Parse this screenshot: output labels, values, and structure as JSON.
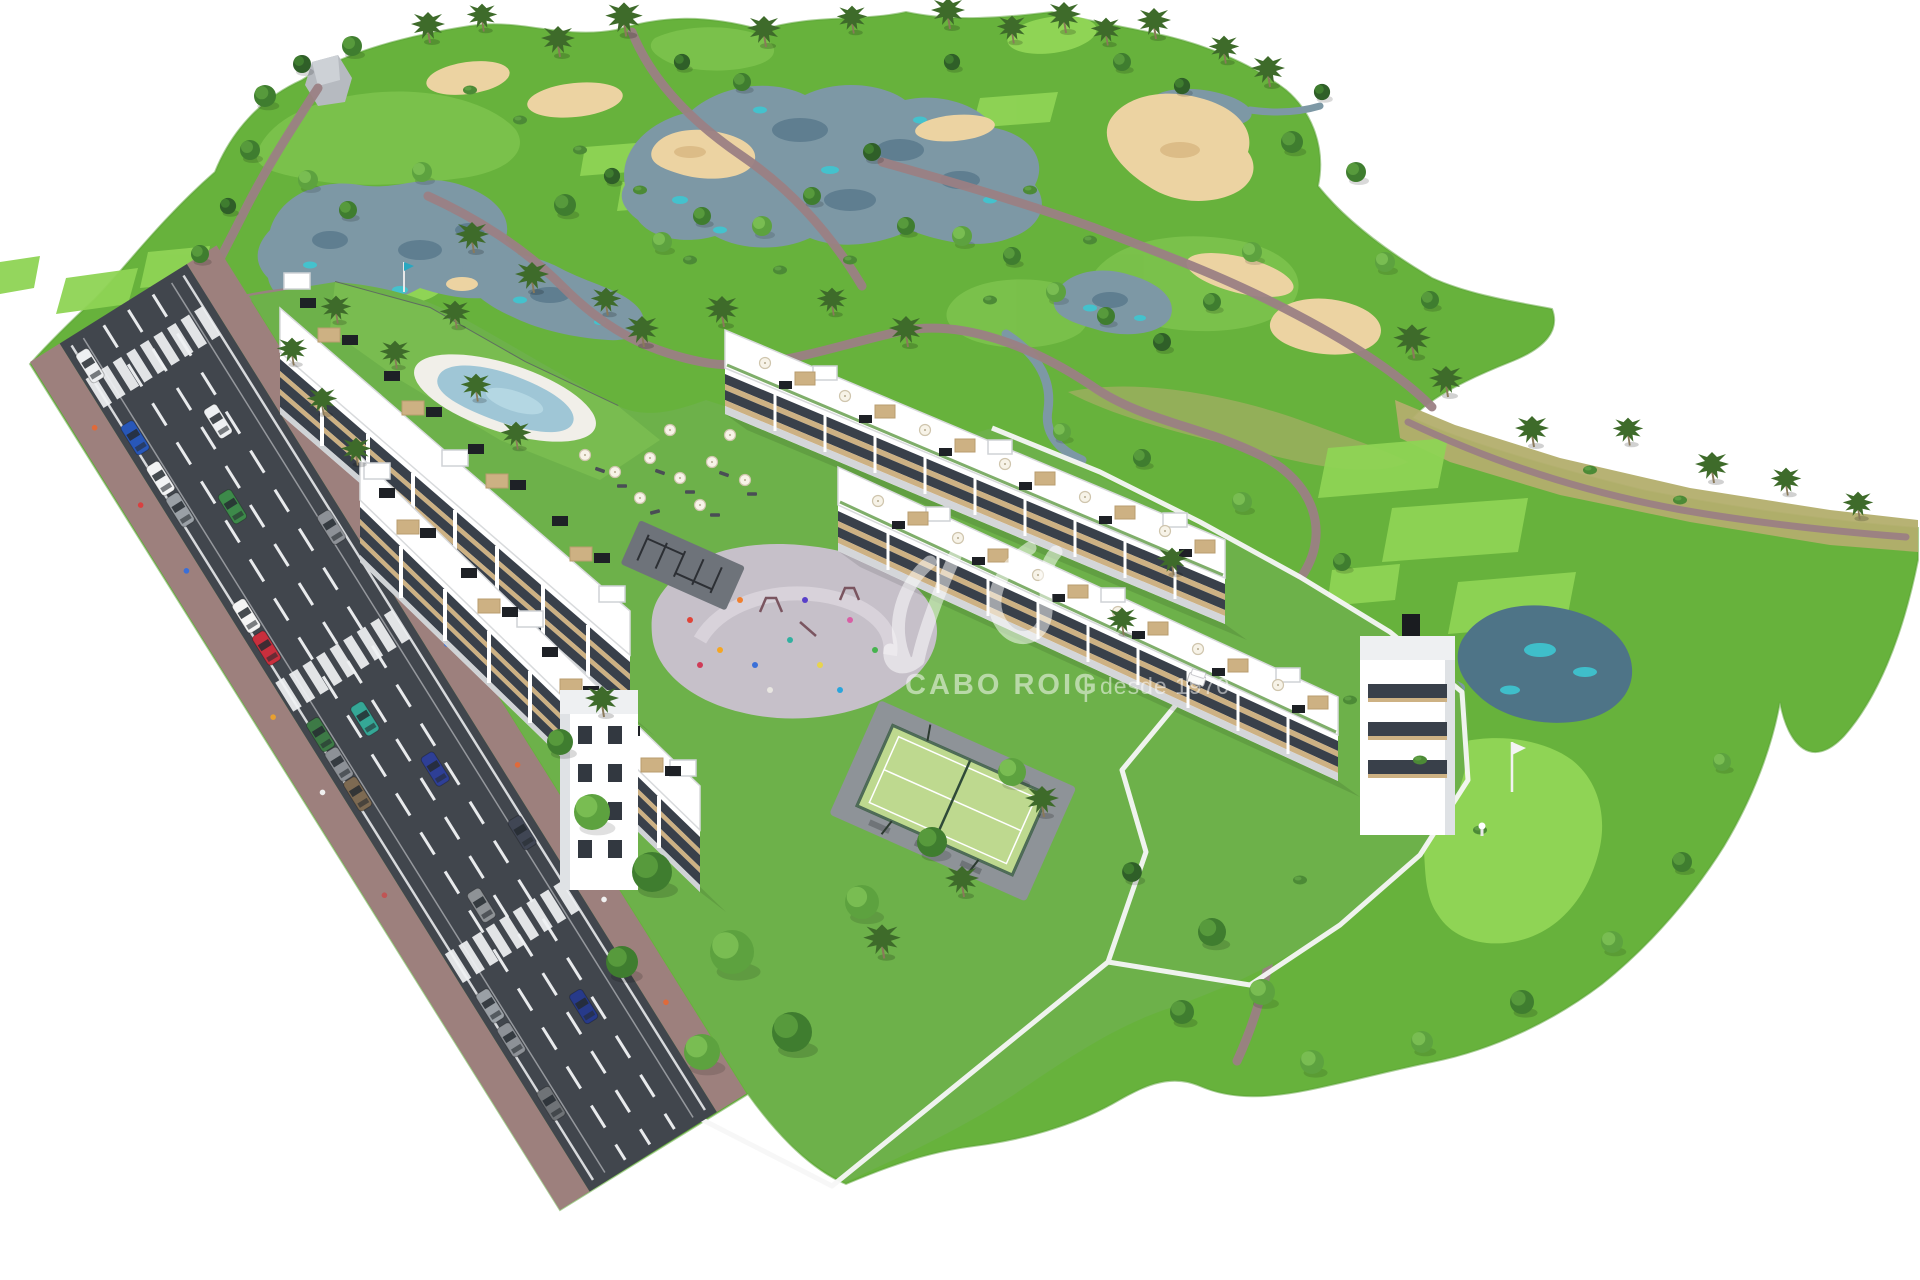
{
  "watermark": {
    "brand": "CABO ROIG",
    "separator": "|",
    "tagline": "desde 1970",
    "logo": "av-monogram",
    "color": "#ffffff",
    "opacity": 0.52
  },
  "scene": {
    "type": "aerial 3d architectural render",
    "subject": "golf resort residential development with apartment blocks, townhouses, pool, padel court and golf course",
    "features": [
      "golf-course",
      "lakes",
      "sand-bunkers",
      "cart-paths",
      "putting-greens",
      "tee-boxes",
      "apartment-buildings",
      "townhouse-rows",
      "swimming-pool",
      "playground-plaza",
      "padel-court",
      "access-road",
      "crosswalks",
      "parked-cars",
      "palm-trees",
      "golf-cart",
      "golfer-with-flag"
    ]
  },
  "palette": {
    "sky": "#ffffff",
    "grass": "#67b23c",
    "grassLight": "#7cc24c",
    "grassBright": "#8fd455",
    "parcelLawn": "#6db14a",
    "roughDry": "#b3ae6d",
    "water": "#7d98a5",
    "waterDark": "#5f7e90",
    "waterDeep": "#4e7487",
    "teal": "#3ec7d2",
    "sand": "#ecd3a2",
    "sandShade": "#dcbc87",
    "cartPath": "#9b8084",
    "asphalt": "#41464d",
    "sidewalk": "#9d807d",
    "building": "#ffffff",
    "glassBand": "#39404a",
    "woodTrim": "#cdb183",
    "poolWater": "#9fc6d6",
    "plaza": "#c6c0c9",
    "padelCourt": "#bed98f",
    "padelFence": "#3c5c46",
    "treeGreen": "#3f7d2f",
    "palmGreen": "#3e6b2a"
  }
}
